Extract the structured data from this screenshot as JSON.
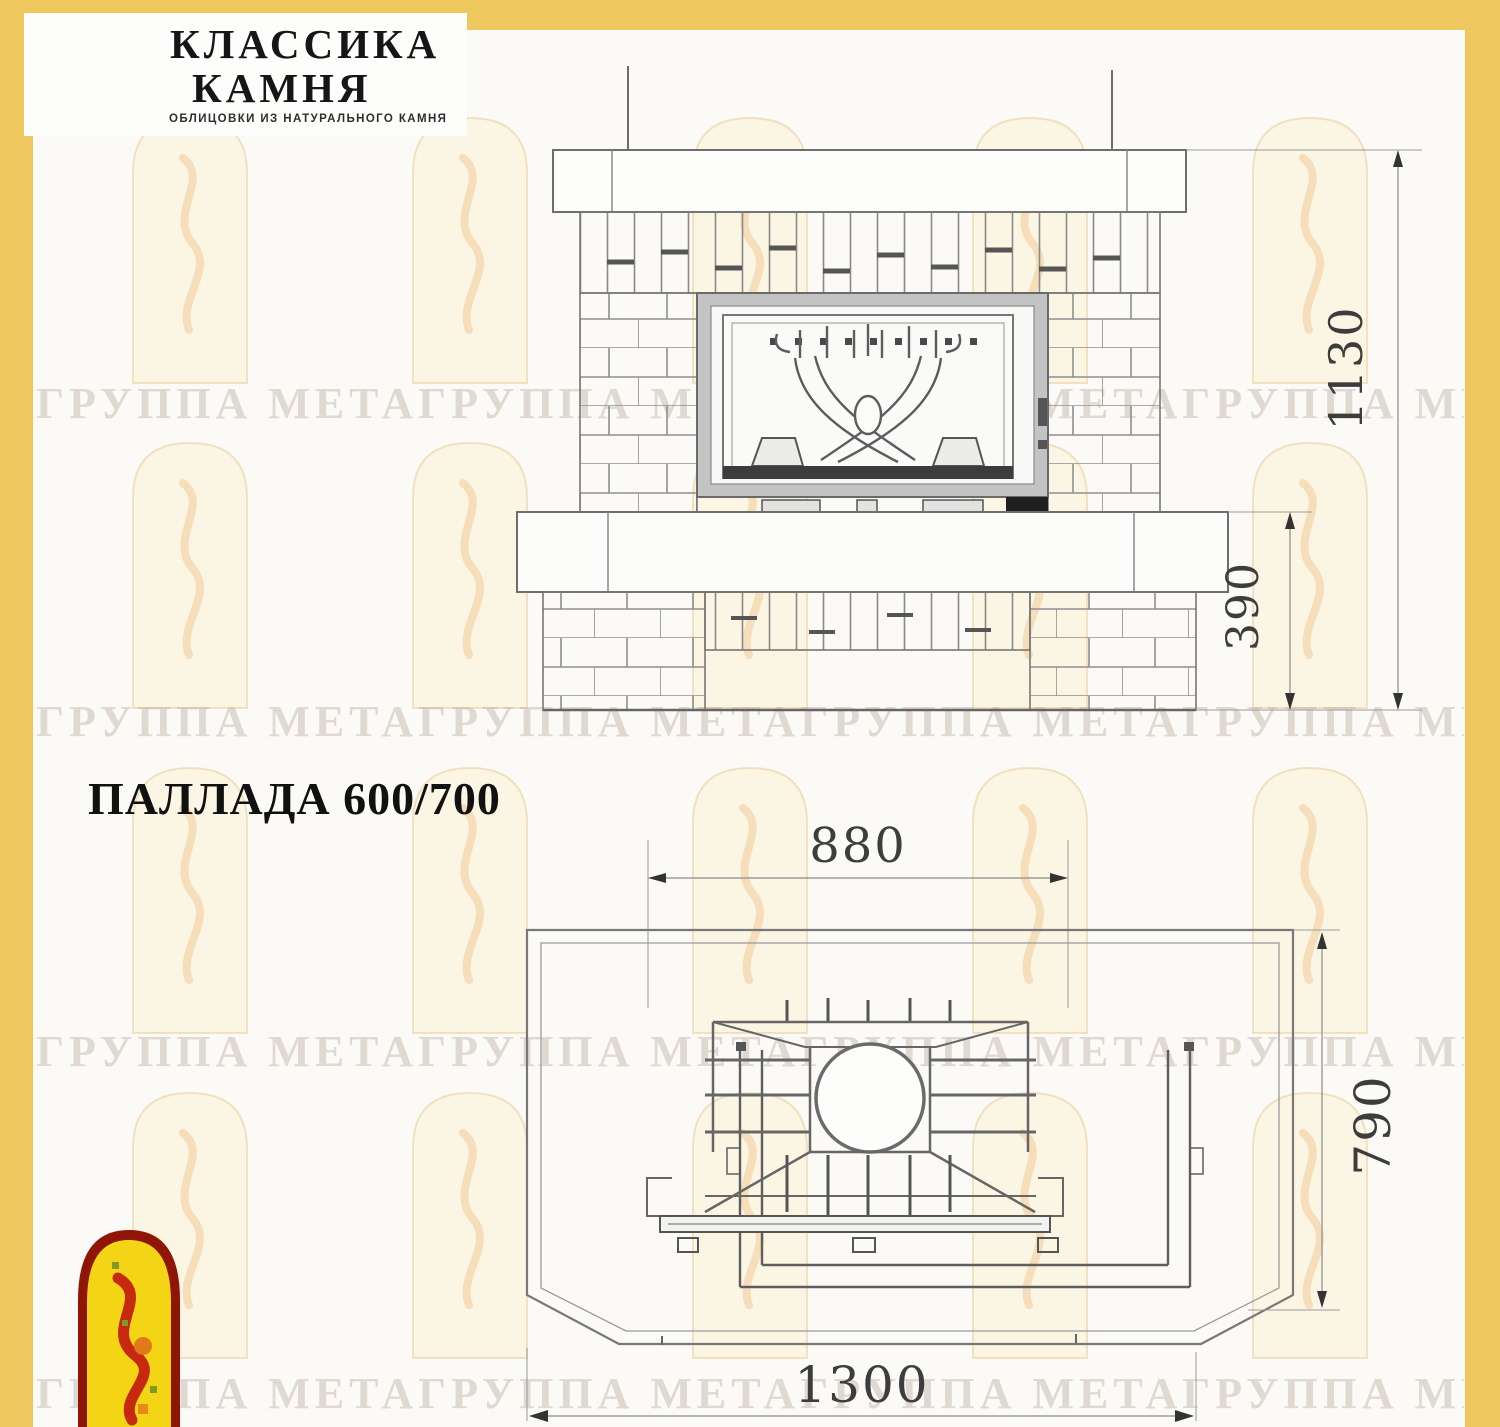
{
  "page": {
    "background": "#fbfaf6",
    "border_color": "#eec75f"
  },
  "header_logo": {
    "name_line1": "КЛАССИКА",
    "name_line2": "КАМНЯ",
    "tagline": "ОБЛИЦОВКИ ИЗ НАТУРАЛЬНОГО КАМНЯ"
  },
  "title": "ПАЛЛАДА 600/700",
  "watermark": {
    "row_text": "ГРУППА МЕТАГРУППА МЕТАГРУППА МЕТАГРУППА МЕТАГРУППА МЕТА"
  },
  "front_elevation": {
    "description": "front elevation of brick fireplace with insert",
    "dim_total_height": "1130",
    "dim_hearth_height": "390"
  },
  "plan_view": {
    "description": "top plan view of fireplace insert",
    "dim_firebox_width": "880",
    "dim_depth": "790",
    "dim_total_width": "1300"
  }
}
